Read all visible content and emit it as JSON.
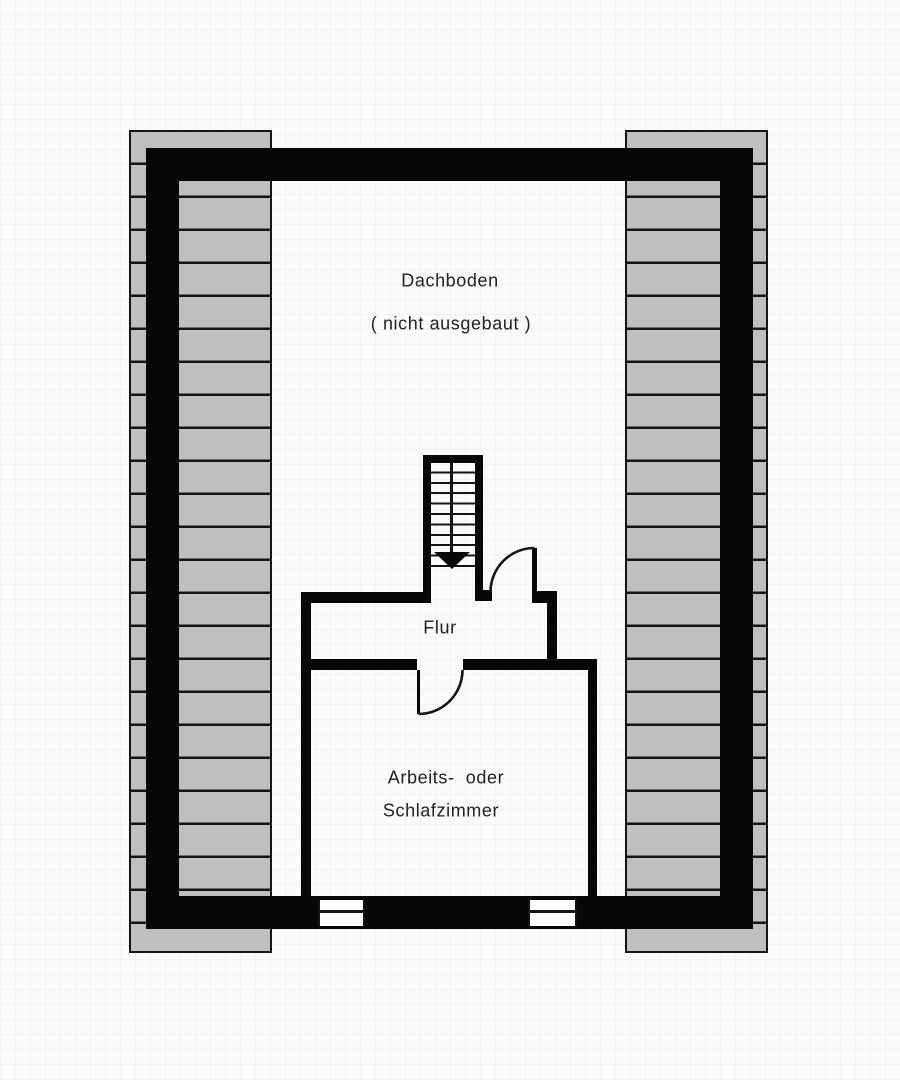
{
  "plan": {
    "title": "Dachboden floor plan",
    "rooms": [
      {
        "name": "attic",
        "label": "Dachboden",
        "sublabel": "( nicht ausgebaut )"
      },
      {
        "name": "hallway",
        "label": "Flur"
      },
      {
        "name": "bedroom",
        "label_line1": "Arbeits-  oder",
        "label_line2": "Schlafzimmer"
      }
    ],
    "labels": {
      "attic": "Dachboden",
      "attic_note": "( nicht ausgebaut )",
      "hall": "Flur",
      "bedroom_line1": "Arbeits-  oder",
      "bedroom_line2": "Schlafzimmer"
    },
    "features": {
      "stair_direction_icon": "down-arrow",
      "windows_count": 2,
      "doors_count": 2
    },
    "colors": {
      "wall": "#070707",
      "hatch_fill": "#bfbfbf",
      "hatch_line": "#141414",
      "background": "#fbfafa",
      "text": "#222222"
    }
  }
}
